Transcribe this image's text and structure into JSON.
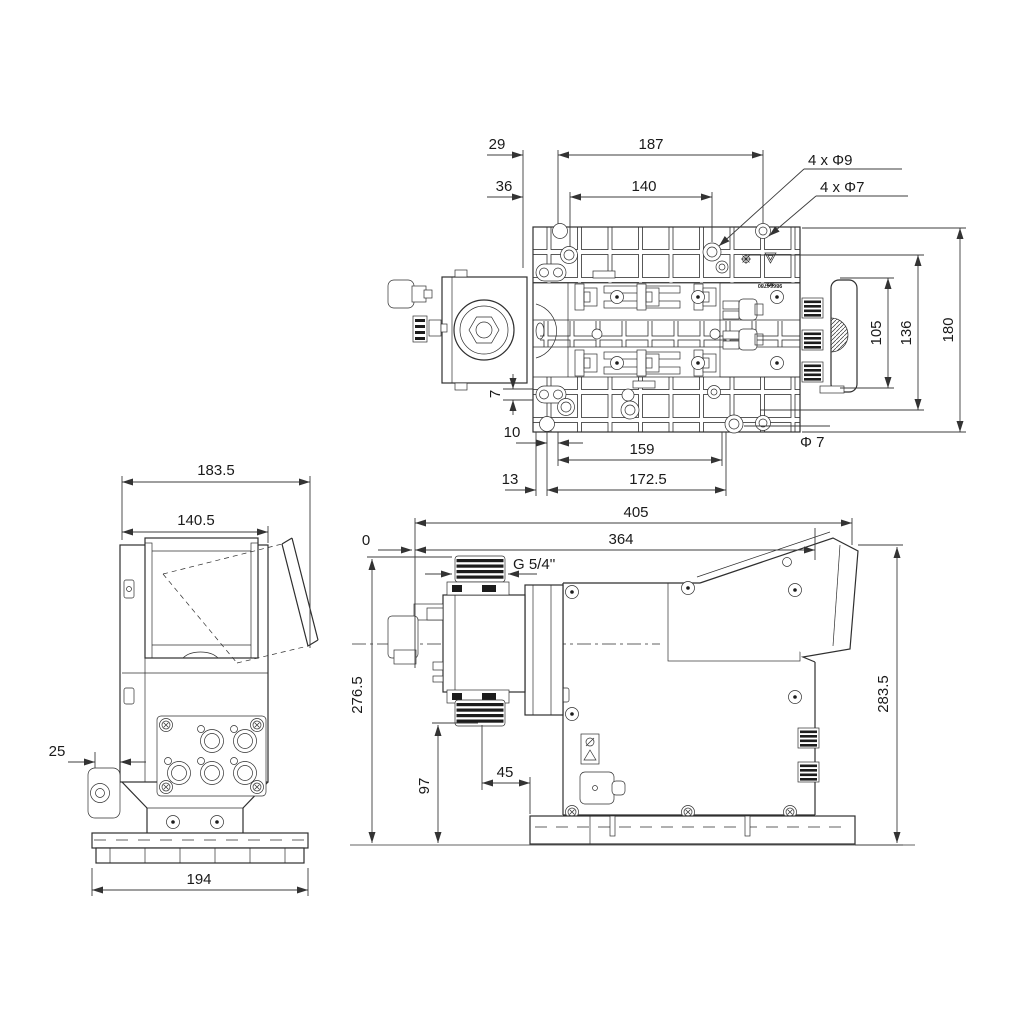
{
  "drawing": {
    "top_view": {
      "dims": {
        "w29": "29",
        "w187": "187",
        "w36": "36",
        "w140": "140",
        "holes9": "4 x Φ9",
        "holes7": "4 x Φ7",
        "h105": "105",
        "h136": "136",
        "h180": "180",
        "gap7": "7",
        "off10": "10",
        "w159": "159",
        "dia7": "Φ 7",
        "off13": "13",
        "w172": "172.5"
      },
      "marking_line1": "x/x",
      "marking_line2": "98664780"
    },
    "front_view": {
      "dims": {
        "w183": "183.5",
        "w140": "140.5",
        "d25": "25",
        "w194": "194"
      }
    },
    "side_view": {
      "dims": {
        "w405": "405",
        "w364": "364",
        "zero": "0",
        "thread": "G 5/4''",
        "h276": "276.5",
        "h97": "97",
        "w45": "45",
        "h283": "283.5"
      }
    },
    "colors": {
      "line": "#2f2f2f",
      "dim": "#3c3c3c",
      "dark": "#1c1c1c",
      "bg": "#ffffff"
    }
  }
}
